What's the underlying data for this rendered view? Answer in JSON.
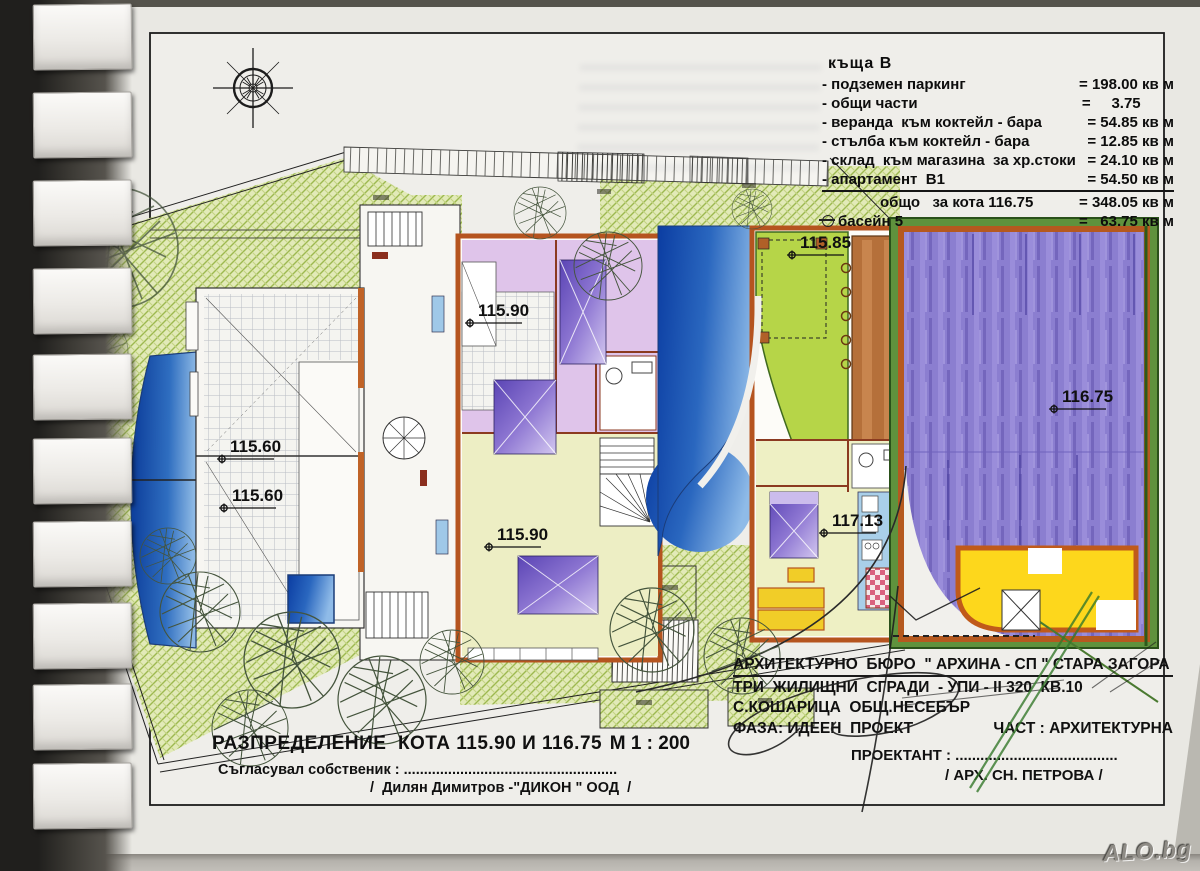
{
  "legend": {
    "title": "къща  В",
    "rows": [
      {
        "label": "- подземен паркинг",
        "value": "= 198.00 кв м"
      },
      {
        "label": "- общи части",
        "value": "=     3.75        "
      },
      {
        "label": "- веранда  към коктейл - бара",
        "value": "= 54.85 кв м"
      },
      {
        "label": "- стълба към коктейл - бара",
        "value": "= 12.85 кв м"
      },
      {
        "label": "- склад  към магазина  за хр.стоки",
        "value": "= 24.10 кв м"
      },
      {
        "label": "- апартамент  В1",
        "value": "= 54.50 кв м"
      },
      {
        "label": "общо   за кота 116.75",
        "value": "= 348.05 кв м"
      },
      {
        "label": "басейн 5",
        "value": "=   63.75 кв м"
      }
    ]
  },
  "elevations": {
    "e1": "115.60",
    "e2": "115.60",
    "e3": "115.90",
    "e4": "115.90",
    "e5": "115.85",
    "e6": "116.75",
    "e7": "117.13"
  },
  "title_block": {
    "drawing_title": "РАЗПРЕДЕЛЕНИЕ  КОТА 115.90 И 116.75",
    "scale": "М 1 : 200",
    "approved_label": "Съгласувал собственик : .....................................................",
    "approved_name": "/  Дилян Димитров -\"ДИКОН \" ООД  /",
    "bureau": "АРХИТЕКТУРНО  БЮРО  \" АРХИНА - СП \" СТАРА ЗАГОРА",
    "project": "ТРИ  ЖИЛИЩНИ  СГРАДИ  - УПИ - II 320  КВ.10",
    "location": "С.КОШАРИЦА  ОБЩ.НЕСЕБЪР",
    "phase": "ФАЗА: ИДЕЕН  ПРОЕКТ",
    "part": "ЧАСТ : АРХИТЕКТУРНА",
    "designer_label": "ПРОЕКТАНТ : .......................................",
    "designer_name": "/ АРХ. СН. ПЕТРОВА /"
  },
  "watermark": {
    "text": "ALO.bg"
  },
  "colors": {
    "wall_orange": "#b5591f",
    "garden_green": "#9db950",
    "pool_blue": "#0b3da2",
    "parking_purple": "#8b7ed0",
    "terrace_green": "#b6d548",
    "bar_yellow": "#fdd71c"
  }
}
